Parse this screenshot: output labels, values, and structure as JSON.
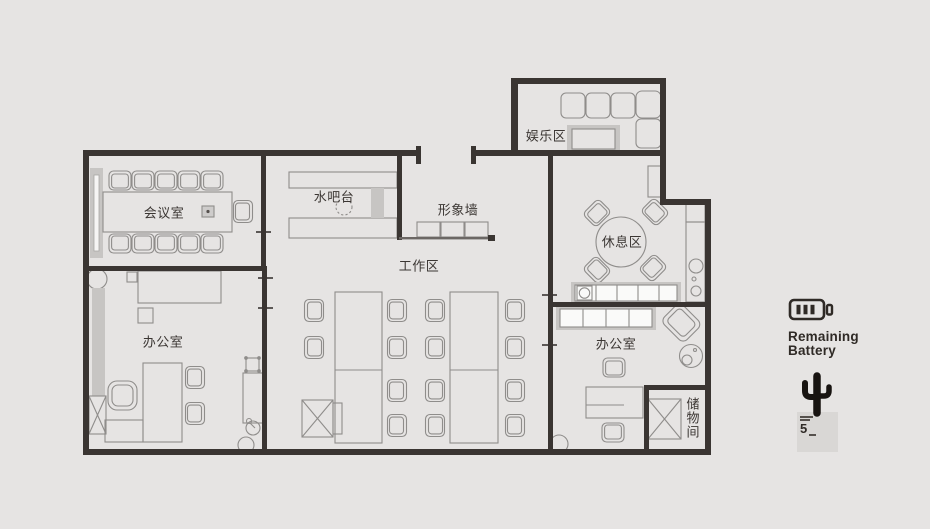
{
  "floorplan": {
    "rooms": {
      "meeting_room": "会议室",
      "water_bar": "水吧台",
      "image_wall": "形象墙",
      "work_area": "工作区",
      "entertainment_area": "娱乐区",
      "rest_area": "休息区",
      "office_left": "办公室",
      "office_right": "办公室",
      "storage_room": "储物间"
    }
  },
  "legend": {
    "battery_line1": "Remaining",
    "battery_line2": "Battery",
    "stamp_number": "5"
  },
  "colors": {
    "background": "#e6e4e3",
    "wall": "#3a3532",
    "furniture_line": "#8f8d8b",
    "furniture_shade": "#c7c5c3",
    "ink": "#2f2a26"
  }
}
